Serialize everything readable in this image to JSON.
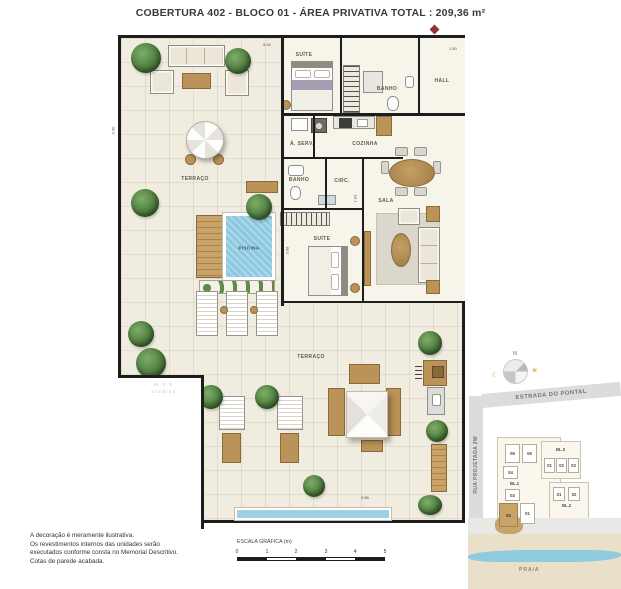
{
  "title": "COBERTURA 402 - BLOCO 01 - ÁREA PRIVATIVA TOTAL :  209,36 m²",
  "plan": {
    "rooms": [
      {
        "label": "TERRAÇO"
      },
      {
        "label": "SUÍTE"
      },
      {
        "label": "BANHO"
      },
      {
        "label": "HALL"
      },
      {
        "label": "Á. SERV."
      },
      {
        "label": "COZINHA"
      },
      {
        "label": "BANHO"
      },
      {
        "label": "CIRC."
      },
      {
        "label": "SALA"
      },
      {
        "label": "SUÍTE"
      },
      {
        "label": "PISCINA"
      },
      {
        "label": "TERRAÇO"
      }
    ],
    "dimensions": [
      "5.45",
      "1.50",
      "9.40",
      "1.63",
      "3.08",
      "5.88"
    ],
    "watermark_line1": "m.h.b",
    "watermark_line2": "studios"
  },
  "disclaimer": {
    "line1": "A decoração é meramente ilustrativa.",
    "line2": "Os revestimentos internos das unidades serão",
    "line3": "executados conforme consta no Memorial Descritivo.",
    "line4": "Cotas de parede acabada."
  },
  "scale_bar": {
    "label": "ESCALA GRÁFICA (m)",
    "ticks": [
      "0",
      "1",
      "2",
      "3",
      "4",
      "5"
    ]
  },
  "site_map": {
    "compass_north": "N",
    "road_top": "ESTRADA DO PONTAL",
    "road_left": "RUA PROJETADA 2W",
    "beach": "PRAIA",
    "block1": {
      "name": "BL.1",
      "unit_05": "05",
      "unit_06": "06",
      "unit_04": "04",
      "unit_03": "03",
      "unit_02": "02",
      "unit_01": "01",
      "highlighted_unit": "02"
    },
    "block3": {
      "name": "BL.3",
      "unit_01": "01",
      "unit_02": "02",
      "unit_03": "03"
    },
    "block2": {
      "name": "BL.2",
      "unit_01": "01",
      "unit_02": "02"
    }
  },
  "colors": {
    "highlight": "#c9a468",
    "pool_blue": "#8cc9e0",
    "wall": "#1d1d1d",
    "entry_marker": "#8a3b2b",
    "water": "#8ecbdd"
  }
}
